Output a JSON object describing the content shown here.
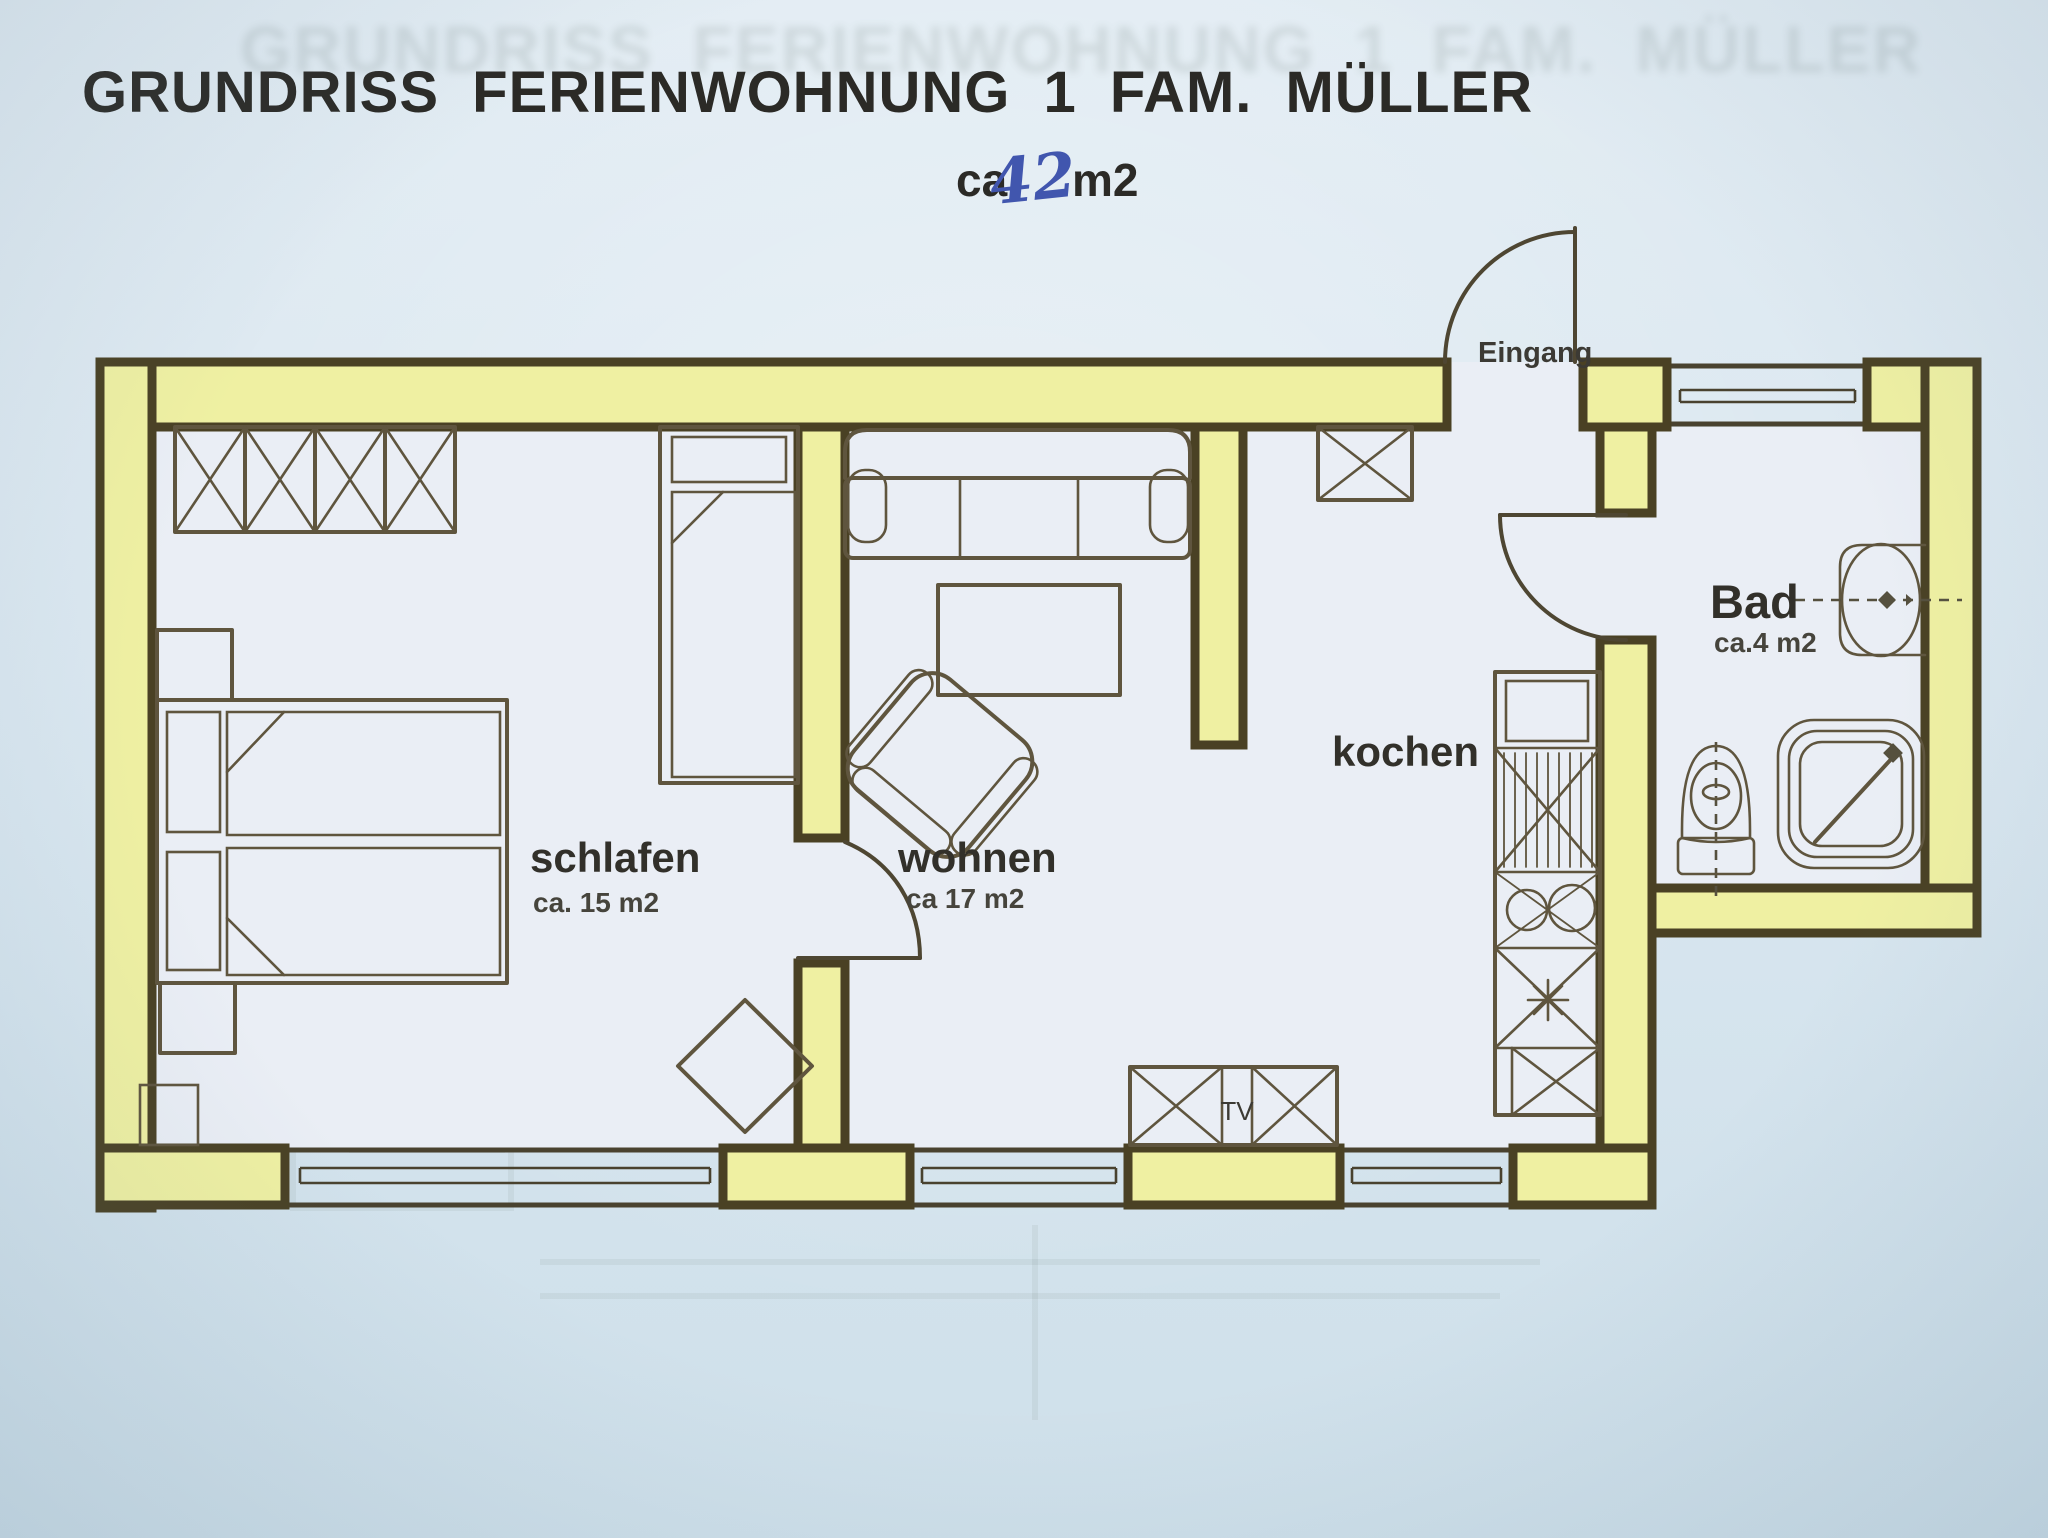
{
  "page": {
    "title": "GRUNDRISS FERIENWOHNUNG 1 FAM. MÜLLER",
    "area_prefix": "ca.",
    "area_value": "42",
    "area_unit": "m2",
    "ghost_title": "GRUNDRISS FERIENWOHNUNG 1 FAM. MÜLLER"
  },
  "rooms": {
    "schlafen": {
      "name": "schlafen",
      "area": "ca. 15 m2"
    },
    "wohnen": {
      "name": "wohnen",
      "area": "ca 17 m2"
    },
    "kochen": {
      "name": "kochen"
    },
    "bad": {
      "name": "Bad",
      "area": "ca.4 m2"
    }
  },
  "labels": {
    "entrance": "Eingang",
    "tv": "TV"
  },
  "colors": {
    "paper": "#dbe7f0",
    "room_fill": "#eaeef5",
    "wall_fill": "#eff0a2",
    "wall_stroke": "#4a4124",
    "furn_line": "#5f553e",
    "label_ink": "#32302a",
    "hand_blue": "#4156ae"
  }
}
